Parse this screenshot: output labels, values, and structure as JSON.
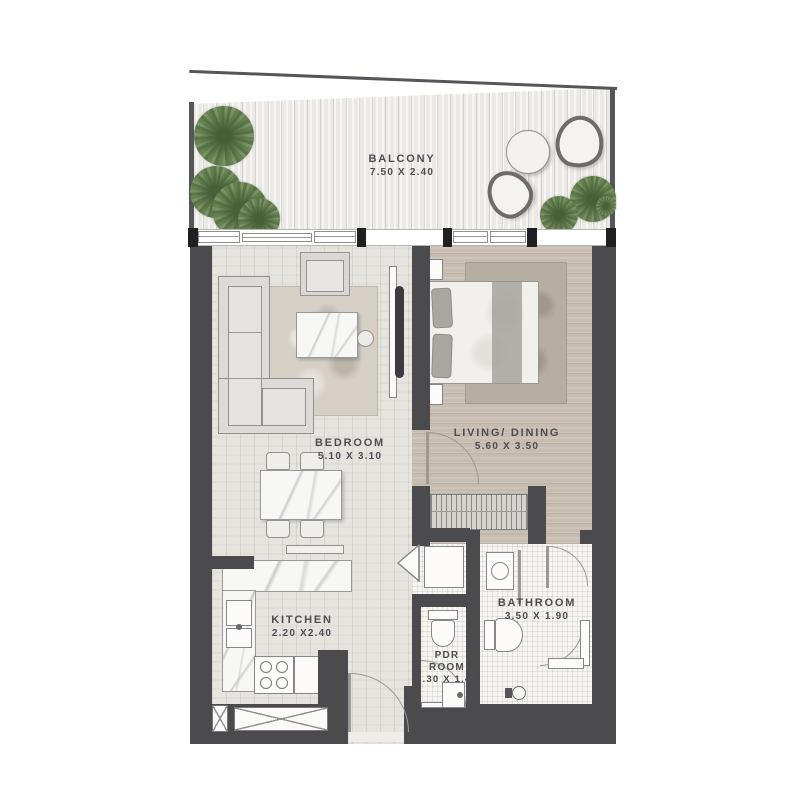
{
  "plan": {
    "name": "apartment-floor-plan",
    "rooms": {
      "balcony": {
        "label": "BALCONY",
        "dims": "7.50 X 2.40"
      },
      "bedroom": {
        "label": "BEDROOM",
        "dims": "5.10 X 3.10"
      },
      "living_dining": {
        "label": "LIVING/ DINING",
        "dims": "5.60 X 3.50"
      },
      "kitchen": {
        "label": "KITCHEN",
        "dims": "2.20 X2.40"
      },
      "bathroom": {
        "label": "BATHROOM",
        "dims": "3.50 X 1.90"
      },
      "pdr": {
        "label_line1": "PDR",
        "label_line2": "ROOM",
        "dims": "2.30 X 1.40"
      }
    },
    "colors": {
      "wall": "#4b4b4e",
      "window_post": "#202022",
      "balcony_floor": "#ebe9e5",
      "wood_light": "#e6e4df",
      "wood_tan": "#c7bcb0",
      "tile": "#f6f5f2",
      "plant_green": "#5f7b4b",
      "label_text": "#4d4d52"
    }
  }
}
